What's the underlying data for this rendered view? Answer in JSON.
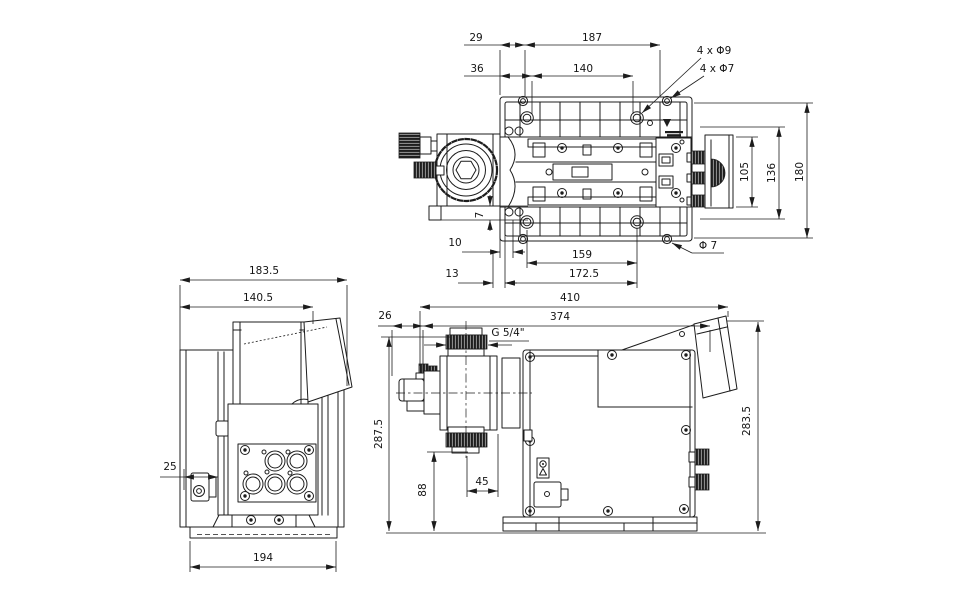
{
  "views": {
    "top": {
      "dims": {
        "d29": "29",
        "d187": "187",
        "d36": "36",
        "d140": "140",
        "holes9": "4 x Φ9",
        "holes7": "4 x Φ7",
        "d105": "105",
        "d136": "136",
        "d180": "180",
        "d7": "7",
        "d10": "10",
        "d159": "159",
        "d172_5": "172.5",
        "d13": "13",
        "dia7": "Φ 7"
      }
    },
    "front": {
      "dims": {
        "d183_5": "183.5",
        "d140_5": "140.5",
        "d25": "25",
        "d194": "194"
      }
    },
    "side": {
      "dims": {
        "d410": "410",
        "d374": "374",
        "d26": "26",
        "thread": "G 5/4\"",
        "d287_5": "287.5",
        "d88": "88",
        "d45": "45",
        "d283_5": "283.5"
      }
    }
  },
  "colors": {
    "line": "#1c1c1c",
    "background": "#ffffff"
  }
}
